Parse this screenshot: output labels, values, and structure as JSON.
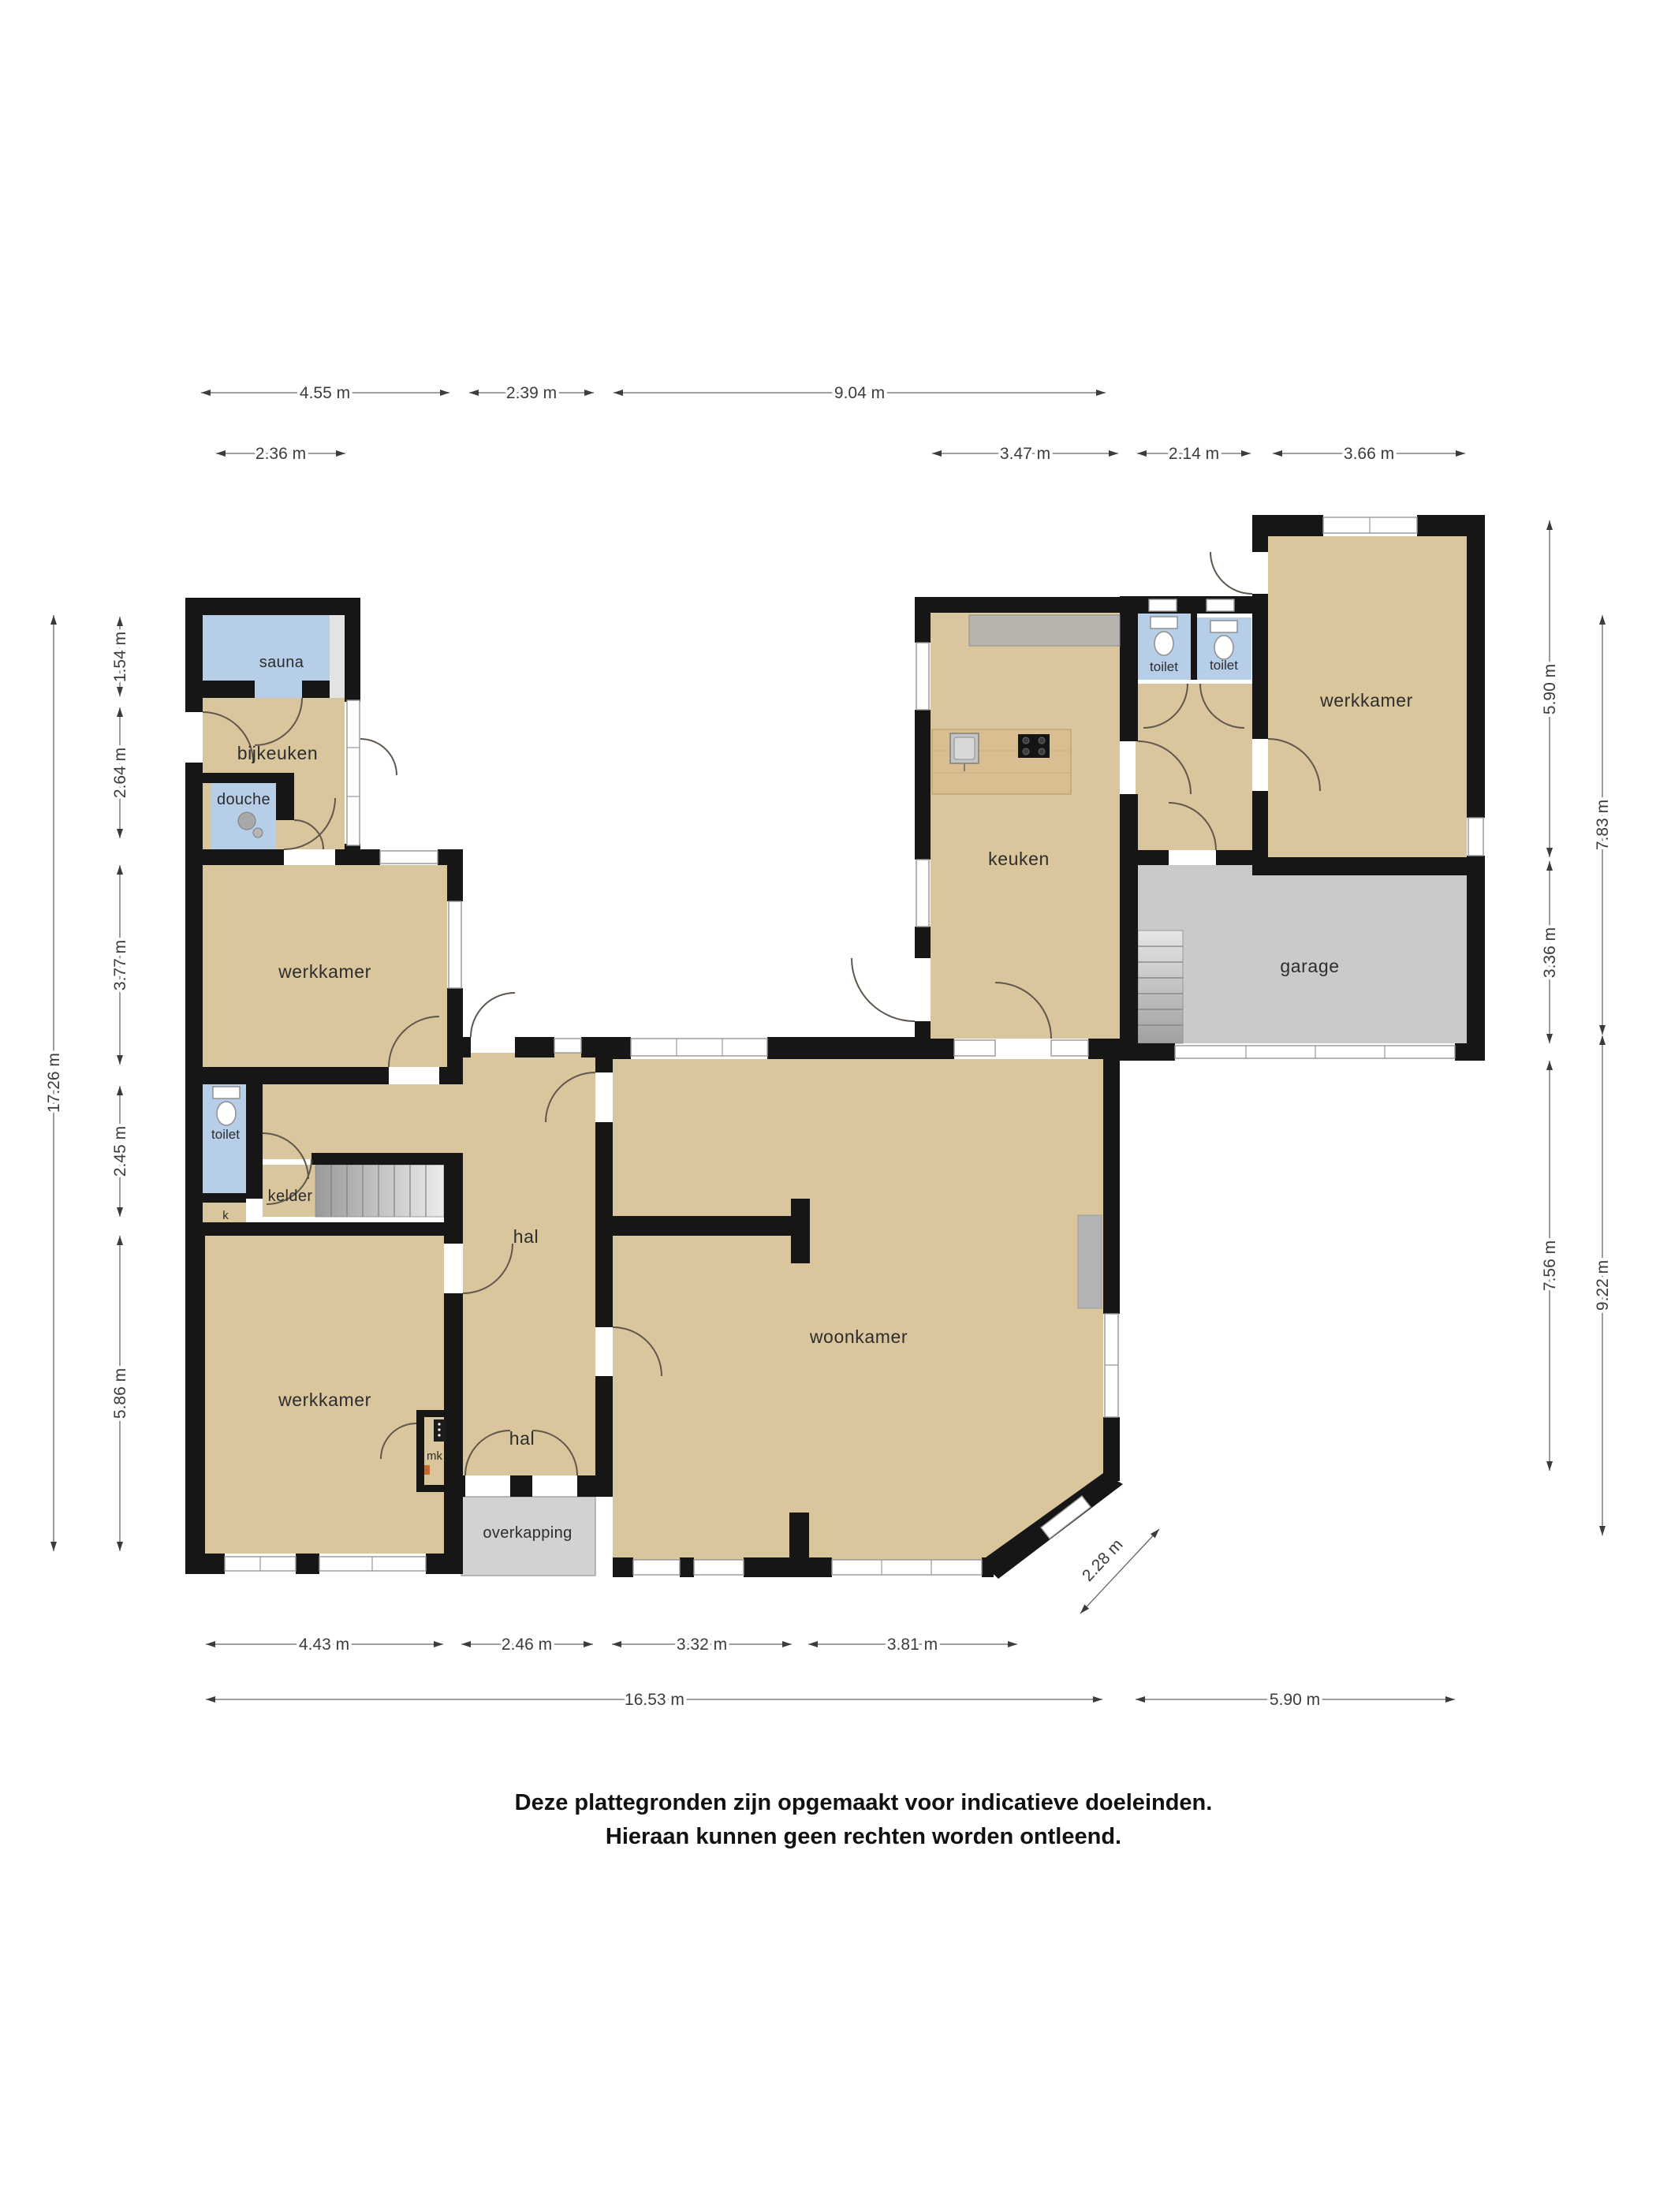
{
  "plan": {
    "rooms": {
      "sauna": "sauna",
      "bijkeuken": "bijkeuken",
      "douche": "douche",
      "werkkamer_ul": "werkkamer",
      "toilet_left": "toilet",
      "kelder": "kelder",
      "k": "k",
      "werkkamer_ll": "werkkamer",
      "mk": "mk",
      "hal_upper": "hal",
      "hal_lower": "hal",
      "overkapping": "overkapping",
      "woonkamer": "woonkamer",
      "keuken": "keuken",
      "toilet_top_1": "toilet",
      "toilet_top_2": "toilet",
      "werkkamer_tr": "werkkamer",
      "garage": "garage"
    },
    "dimensions": {
      "top_row1": {
        "a": "4.55 m",
        "b": "2.39 m",
        "c": "9.04 m"
      },
      "top_row2": {
        "a": "2.36 m",
        "b": "3.47 m",
        "c": "2.14 m",
        "d": "3.66 m"
      },
      "left_inner": {
        "a": "1.54 m",
        "b": "2.64 m",
        "c": "3.77 m",
        "d": "2.45 m",
        "e": "5.86 m"
      },
      "left_outer": {
        "a": "17.26 m"
      },
      "right_inner": {
        "a": "5.90 m",
        "b": "3.36 m",
        "c": "7.56 m"
      },
      "right_outer": {
        "a": "7.83 m",
        "b": "9.22 m"
      },
      "bottom_row1": {
        "a": "4.43 m",
        "b": "2.46 m",
        "c": "3.32 m",
        "d": "3.81 m"
      },
      "bottom_row2": {
        "a": "16.53 m",
        "b": "5.90 m"
      },
      "diagonal": {
        "a": "2.28 m"
      }
    },
    "disclaimer": {
      "line1": "Deze plattegronden zijn opgemaakt voor indicatieve doeleinden.",
      "line2": "Hieraan kunnen geen rechten worden ontleend."
    },
    "colors": {
      "wall": "#161616",
      "floor": "#d9c69c",
      "wet": "#b6cee7",
      "garage_floor": "#cacaca",
      "overkapping_floor": "#d2d2d2",
      "wood": "#dabe92",
      "counter": "#b7b4ae",
      "fireplace": "#b3b3b3"
    }
  }
}
